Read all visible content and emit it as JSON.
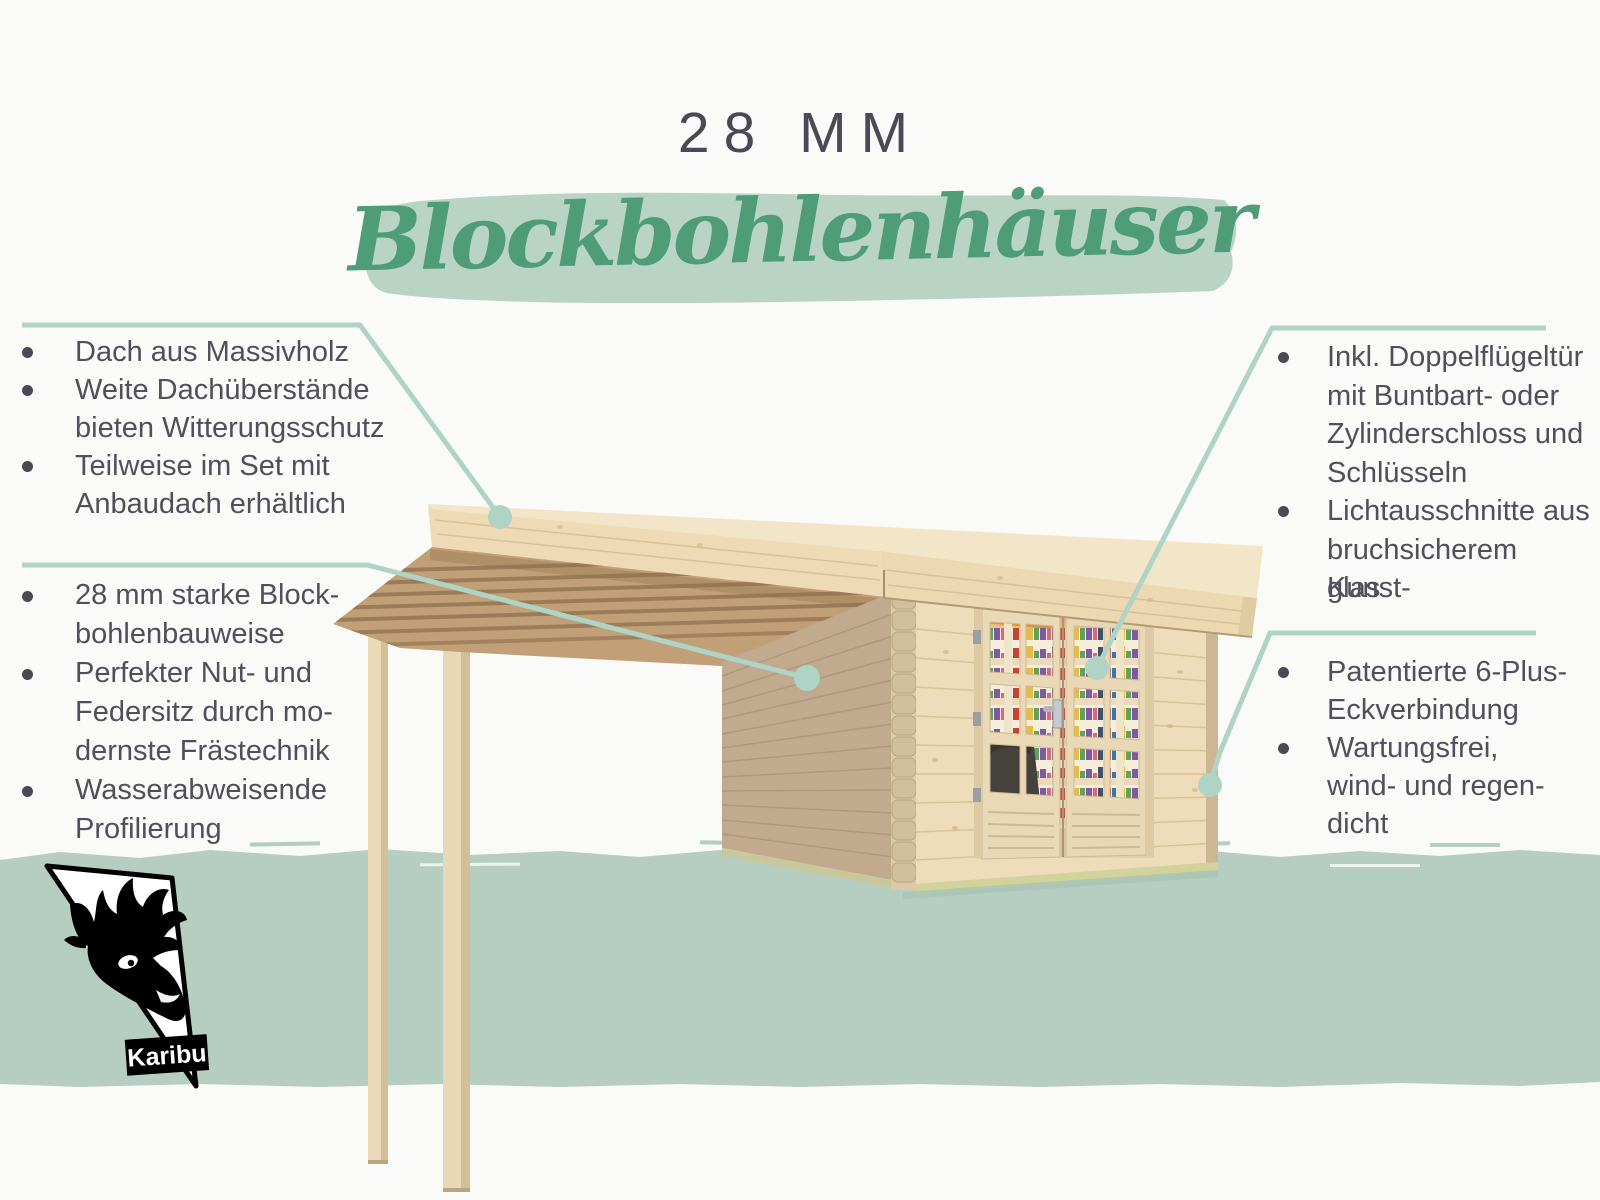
{
  "title": "28 MM",
  "headline": "Blockbohlenhäuser",
  "brand": "Karibu",
  "theme": {
    "green": "#4f9c78",
    "brush": "#b9d4c5",
    "ground": "#b5cec1",
    "callout": "#afd4c6",
    "text": "#50505a",
    "wood_top": "#f3e6c8",
    "wood_fascia": "#ecd9b2",
    "wood_side": "#c1aa8e",
    "wood_front": "#eedcba",
    "wood_joist": "#c2a077"
  },
  "features": {
    "roof": {
      "lines": [
        {
          "b": 1,
          "t": "Dach aus Massivholz"
        },
        {
          "b": 1,
          "t": "Weite Dachüberstände"
        },
        {
          "b": 0,
          "t": "bieten Witterungsschutz"
        },
        {
          "b": 1,
          "t": "Teilweise im Set mit"
        },
        {
          "b": 0,
          "t": "Anbaudach erhältlich"
        }
      ]
    },
    "wall": {
      "lines": [
        {
          "b": 1,
          "t": "28 mm starke Block-"
        },
        {
          "b": 0,
          "t": "bohlenbauweise"
        },
        {
          "b": 1,
          "t": "Perfekter Nut- und"
        },
        {
          "b": 0,
          "t": "Federsitz durch mo-"
        },
        {
          "b": 0,
          "t": "dernste Frästechnik"
        },
        {
          "b": 1,
          "t": "Wasserabweisende"
        },
        {
          "b": 0,
          "t": "Profilierung"
        }
      ]
    },
    "door": {
      "lines": [
        {
          "b": 1,
          "t": "Inkl. Doppelflügeltür"
        },
        {
          "b": 0,
          "t": "mit Buntbart- oder"
        },
        {
          "b": 0,
          "t": "Zylinderschloss und"
        },
        {
          "b": 0,
          "t": "Schlüsseln"
        },
        {
          "b": 1,
          "t": "Lichtausschnitte aus"
        },
        {
          "b": 0,
          "t": "bruchsicherem Kunst-"
        },
        {
          "b": 0,
          "t": "glas"
        }
      ]
    },
    "corner": {
      "lines": [
        {
          "b": 1,
          "t": "Patentierte 6-Plus-"
        },
        {
          "b": 0,
          "t": "Eckverbindung"
        },
        {
          "b": 1,
          "t": "Wartungsfrei,"
        },
        {
          "b": 0,
          "t": "wind- und regen-"
        },
        {
          "b": 0,
          "t": "dicht"
        }
      ]
    }
  }
}
